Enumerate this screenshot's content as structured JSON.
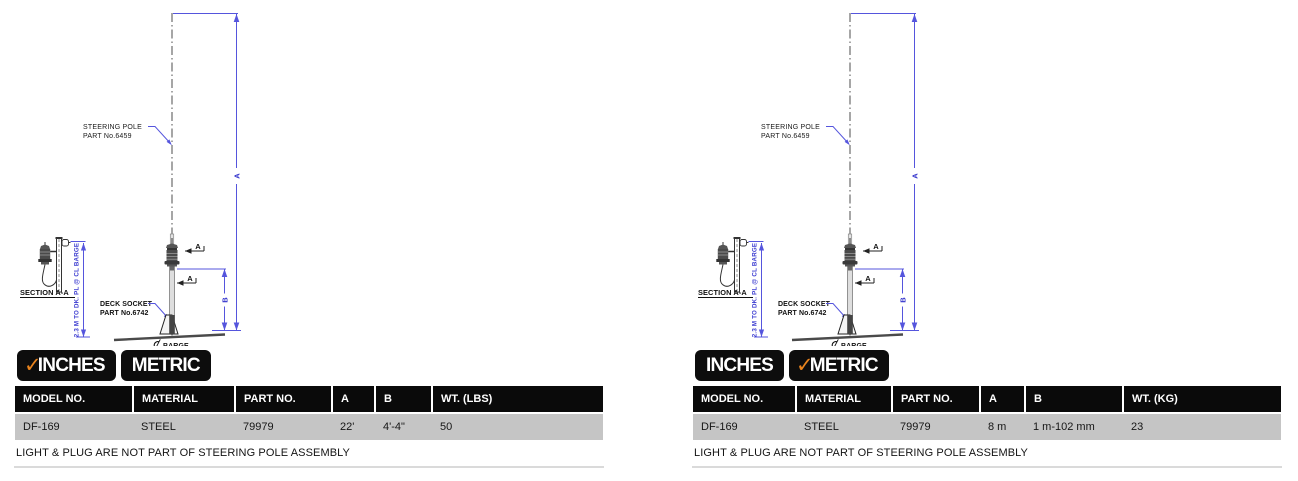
{
  "colors": {
    "accent_orange": "#e8831d",
    "tab_black": "#0d0d0d",
    "row_gray": "#c5c5c5",
    "dimension_blue": "#4444d4"
  },
  "icons": {
    "check": "✓",
    "centerline_symbol": "℄"
  },
  "tabs": {
    "inches": "INCHES",
    "metric": "METRIC"
  },
  "drawing": {
    "steering_pole_label_line1": "STEERING POLE",
    "steering_pole_label_line2": "PART No.6459",
    "deck_socket_label_line1": "DECK SOCKET",
    "deck_socket_label_line2": "PART No.6742",
    "section_label": "SECTION A-A",
    "vertical_dim_label": "2.3 M TO DK. PL @ CL BARGE",
    "dim_a": "A",
    "dim_b": "B",
    "section_cut_a": "A",
    "barge_label": "BARGE"
  },
  "panels": [
    {
      "name": "inches",
      "active_tab": "INCHES",
      "table": {
        "headers": [
          "MODEL NO.",
          "MATERIAL",
          "PART NO.",
          "A",
          "B",
          "WT. (LBS)"
        ],
        "row": [
          "DF-169",
          "STEEL",
          "79979",
          "22'",
          "4'-4\"",
          "50"
        ]
      },
      "note": "LIGHT & PLUG ARE NOT PART OF STEERING POLE ASSEMBLY"
    },
    {
      "name": "metric",
      "active_tab": "METRIC",
      "table": {
        "headers": [
          "MODEL NO.",
          "MATERIAL",
          "PART NO.",
          "A",
          "B",
          "WT. (KG)"
        ],
        "row": [
          "DF-169",
          "STEEL",
          "79979",
          "8 m",
          "1 m-102 mm",
          "23"
        ]
      },
      "note": "LIGHT & PLUG ARE NOT PART OF STEERING POLE ASSEMBLY"
    }
  ]
}
